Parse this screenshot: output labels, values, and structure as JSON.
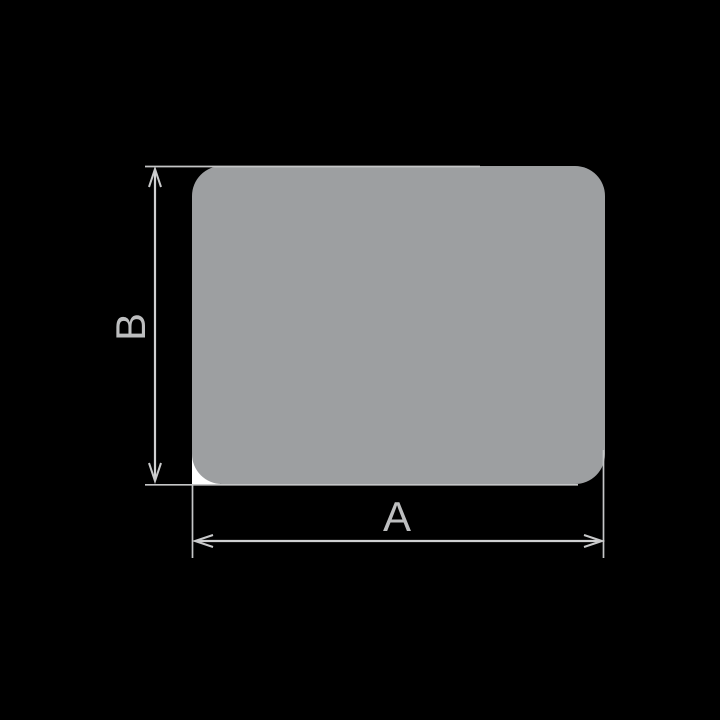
{
  "canvas": {
    "width": 720,
    "height": 720,
    "background_color": "#000000"
  },
  "figure": {
    "description": "Dimensioned cross-section drawing of a flat rounded-corner rectangular profile",
    "shape": {
      "name": "rounded-rectangle-profile",
      "fill": "#9d9fa1",
      "corner_notch_fill": "#ffffff"
    },
    "line_color": "#c9cacb",
    "label_color": "#bdbebf",
    "dimensions": [
      {
        "id": "A",
        "label": "A",
        "orientation": "horizontal",
        "measures": "width"
      },
      {
        "id": "B",
        "label": "B",
        "orientation": "vertical",
        "measures": "height"
      }
    ]
  }
}
